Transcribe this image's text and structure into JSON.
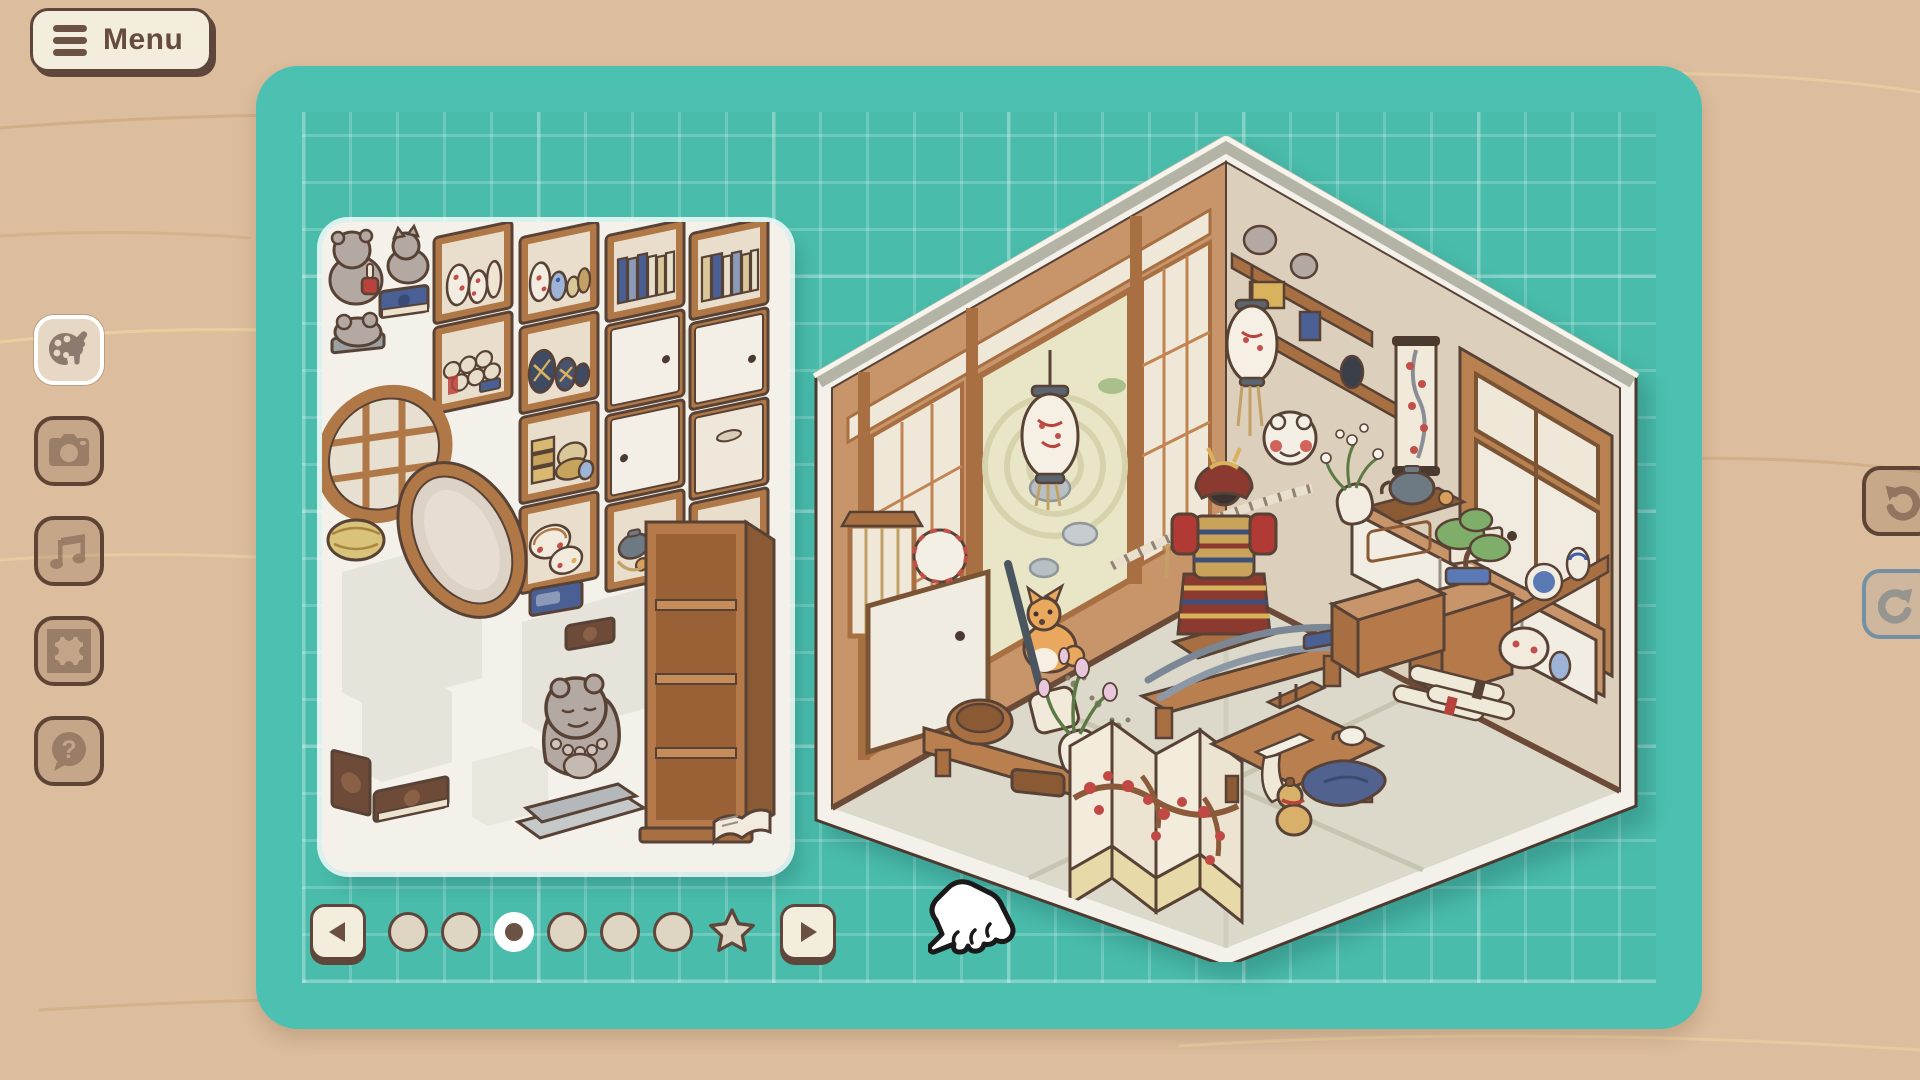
{
  "menu": {
    "label": "Menu"
  },
  "toolbar": {
    "items": [
      {
        "name": "customize",
        "icon": "palette-brush-icon",
        "active": true
      },
      {
        "name": "photo",
        "icon": "camera-icon",
        "active": false
      },
      {
        "name": "music",
        "icon": "music-note-icon",
        "active": false
      },
      {
        "name": "frame",
        "icon": "picture-frame-icon",
        "active": false
      },
      {
        "name": "help",
        "icon": "question-bubble-icon",
        "active": false
      }
    ]
  },
  "history": {
    "undo": {
      "icon": "undo-arrow-icon",
      "enabled": true
    },
    "redo": {
      "icon": "redo-arrow-icon",
      "enabled": false
    }
  },
  "pagination": {
    "total": 7,
    "active_index": 2,
    "star_last": true,
    "prev_icon": "arrow-left-icon",
    "next_icon": "arrow-right-icon"
  },
  "board": {
    "grid": true
  },
  "inventory": {
    "items": [
      "frog-figurine-with-candle",
      "lucky-cat-figurine",
      "blue-book",
      "small-frog-statue",
      "shelf-red-plum-vases",
      "shelf-scrolls",
      "shelf-blue-white-vases",
      "shelf-dark-jars",
      "shelf-gold-boxes",
      "shelf-red-baskets",
      "shelf-blue-books",
      "sliding-door-panel",
      "sliding-door-panel-2",
      "shelf-grey-tea-set",
      "shelf-mixed-books",
      "sliding-door-panel-3",
      "drawer-panel",
      "shelf-teapots",
      "round-lattice-window",
      "straw-basket",
      "oval-mirror",
      "small-blue-book",
      "small-brown-book",
      "tall-empty-bookshelf",
      "frog-monk-statue",
      "brown-book-standing",
      "brown-book-flat",
      "open-book"
    ]
  },
  "room": {
    "theme": "japanese-antique-room",
    "objects": [
      "paper-lantern-left",
      "paper-lantern-right",
      "shimenawa-rope",
      "zen-garden-doorway",
      "samurai-armor",
      "shiba-dog",
      "sword-stand-bench",
      "white-sliding-cabinets",
      "grey-teapot-tray",
      "white-flower-vase",
      "bonsai-on-chest",
      "frog-mask",
      "hanging-scroll",
      "wall-shelves-cat-figurines",
      "corner-window",
      "corner-shelf-porcelain",
      "lattice-floor-lamp",
      "side-cabinet-with-drum",
      "shamisen",
      "wooden-bench-with-barrel",
      "lily-vase",
      "folding-screen-plum",
      "low-writing-table",
      "scroll-pile",
      "blue-cushion",
      "gourd",
      "carved-chest",
      "paw-prints"
    ]
  },
  "colors": {
    "background": "#dcbd9d",
    "board": "#4cc1b1",
    "grid_line": "rgba(255,255,255,0.2)",
    "cream": "#f3edde",
    "dark_brown": "#5f463a",
    "icon_brown": "#6d5242",
    "tray": "#f3f1ea",
    "active_border": "#ffffff",
    "redo_border": "#7391a2",
    "room_wood": "#c8946a",
    "room_plaster": "#dccfbb",
    "room_floor": "#dcd8ca",
    "accent_red": "#bf4a40",
    "accent_navy": "#3e4f7a",
    "accent_gold": "#d8b25c"
  }
}
